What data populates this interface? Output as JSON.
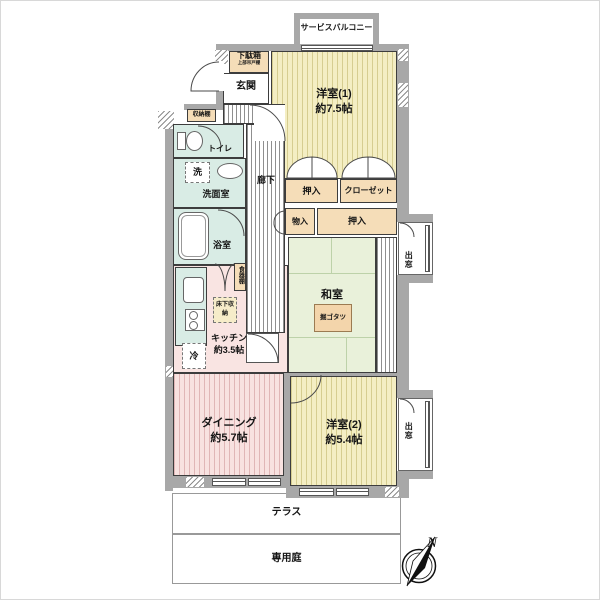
{
  "floorplan": {
    "outdoor": {
      "service_balcony": "サービスバルコニー",
      "terrace": "テラス",
      "private_garden": "専用庭",
      "bay_window_upper": "出窓",
      "bay_window_lower": "出窓"
    },
    "entrance": {
      "genkan": "玄関",
      "getabako": "下駄箱",
      "getabako_note": "上部吊戸棚",
      "shoe_shelf": "収納棚"
    },
    "rooms": {
      "western1_name": "洋室(1)",
      "western1_size": "約7.5帖",
      "western2_name": "洋室(2)",
      "western2_size": "約5.4帖",
      "japanese_name": "和室",
      "kotatsu": "掘ゴタツ",
      "dining_name": "ダイニング",
      "dining_size": "約5.7帖",
      "kitchen_name": "キッチン",
      "kitchen_size": "約3.5帖",
      "hallway": "廊下",
      "toilet": "トイレ",
      "washroom": "洗面室",
      "washer": "洗",
      "bathroom": "浴室"
    },
    "storage": {
      "oshiire_upper": "押入",
      "closet": "クローゼット",
      "monoire": "物入",
      "oshiire_center": "押入",
      "cupboard": "食器棚",
      "underfloor_storage": "床下収納",
      "fridge": "冷"
    },
    "compass": {
      "north": "N"
    },
    "colors": {
      "wall": "#a8a8a8",
      "western_room": "#f4eec3",
      "japanese_room": "#e9f1da",
      "dining_kitchen": "#f8e2e0",
      "wet_area": "#d9ece5",
      "closet": "#f5ddb8",
      "kotatsu": "#f3d5ab"
    }
  }
}
